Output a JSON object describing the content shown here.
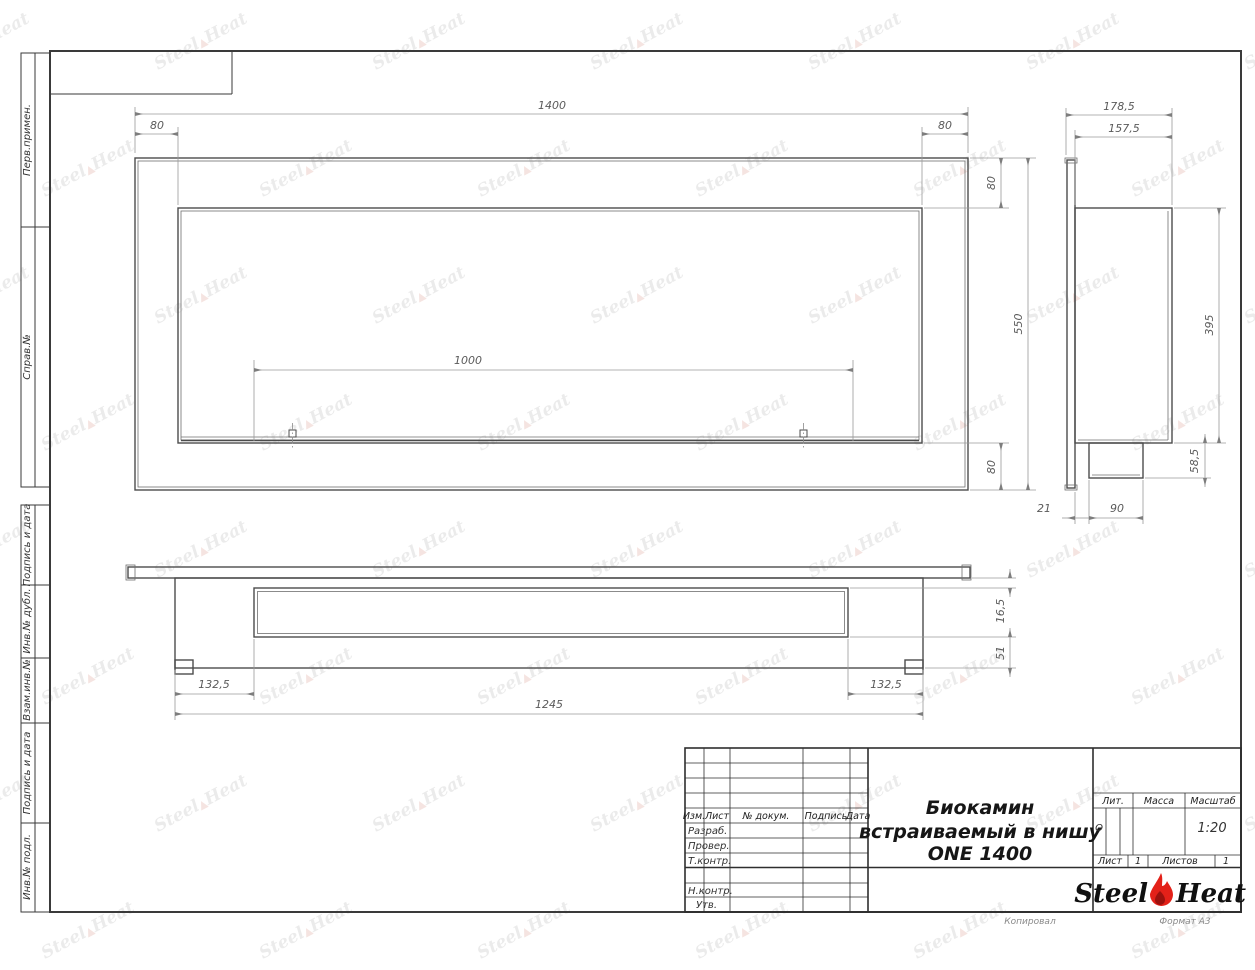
{
  "sheet": {
    "footer": {
      "copy": "Копировал",
      "format": "Формат A3"
    },
    "watermark": {
      "steel": "Steel",
      "heat": "Heat"
    }
  },
  "sidebar": {
    "items": [
      {
        "label": "Перв.примен."
      },
      {
        "label": "Справ.№"
      },
      {
        "label": "Подпись и дата"
      },
      {
        "label": "Инв.№ дубл."
      },
      {
        "label": "Взам.инв.№"
      },
      {
        "label": "Подпись и дата"
      },
      {
        "label": "Инв.№ подл."
      }
    ]
  },
  "front_view": {
    "dims": {
      "total_width": "1400",
      "left_inset": "80",
      "right_inset": "80",
      "opening_width": "1000",
      "total_height": "550",
      "top_inset": "80",
      "bottom_inset": "80"
    }
  },
  "side_view": {
    "dims": {
      "total_depth": "178,5",
      "body_depth": "157,5",
      "body_height": "395",
      "tray_height": "58,5",
      "flange_offset": "21",
      "tray_depth": "90"
    }
  },
  "plan_view": {
    "dims": {
      "slot_front_offset": "16,5",
      "slot_back_offset": "51",
      "slot_left_inset": "132,5",
      "body_length": "1245",
      "slot_right_inset": "132,5"
    }
  },
  "title_block": {
    "header": {
      "izm": "Изм.",
      "list": "Лист",
      "doc": "№ докум.",
      "podpis": "Подпись",
      "data": "Дата"
    },
    "rows": {
      "razrab": "Разраб.",
      "prover": "Провер.",
      "tkontr": "Т.контр.",
      "nkontr": "Н.контр.",
      "utv": "Утв."
    },
    "doc_title": {
      "line1": "Биокамин",
      "line2": "встраиваемый в нишу",
      "line3": "ONE 1400"
    },
    "lit": {
      "label": "Лит.",
      "value": "О"
    },
    "mass": {
      "label": "Масса"
    },
    "scale": {
      "label": "Масштаб",
      "value": "1:20"
    },
    "sheet": {
      "label": "Лист",
      "value": "1"
    },
    "sheets": {
      "label": "Листов",
      "value": "1"
    },
    "logo": {
      "steel": "Steel",
      "heat": "Heat",
      "flame_color": "#e32119",
      "flame_inner_color": "#9b120e"
    }
  }
}
